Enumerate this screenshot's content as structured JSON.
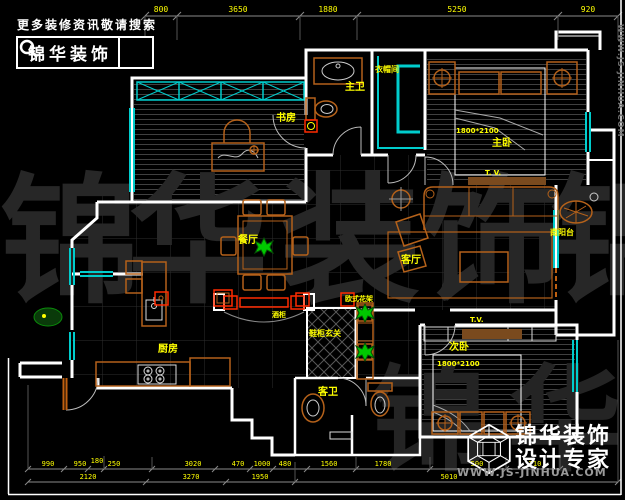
{
  "branding": {
    "search_hint": "更多装修资讯敬请搜索",
    "logo_text": "锦华装饰",
    "side_url": "WWW.JS-JINHUA.COM",
    "footer": {
      "line1": "锦华装饰",
      "line2": "设计专家",
      "url": "WWW.JS-JINHUA.COM"
    }
  },
  "watermark": {
    "row1": [
      "锦",
      "华",
      "装",
      "饰",
      "锦"
    ],
    "row2": [
      "锦",
      "华"
    ]
  },
  "floorplan": {
    "rooms": [
      {
        "id": "study",
        "label": "书房"
      },
      {
        "id": "master-bath",
        "label": "主卫"
      },
      {
        "id": "closet",
        "label": "衣帽间"
      },
      {
        "id": "master-bedroom",
        "label": "主卧"
      },
      {
        "id": "dining",
        "label": "餐厅"
      },
      {
        "id": "living",
        "label": "客厅"
      },
      {
        "id": "balcony",
        "label": "南阳台"
      },
      {
        "id": "kitchen",
        "label": "厨房"
      },
      {
        "id": "entry",
        "label": "鞋柜玄关"
      },
      {
        "id": "guest-bath",
        "label": "客卫"
      },
      {
        "id": "second-bedroom",
        "label": "次卧"
      }
    ],
    "annotations": {
      "master_bed_size": "1800*2100",
      "second_bed_size": "1800*2100",
      "master_tv": "T. V.",
      "second_tv": "T.V.",
      "wine_cabinet": "酒柜",
      "flower_stand": "欧式花架"
    }
  },
  "dimensions": {
    "top": [
      "800",
      "3650",
      "1880",
      "5250",
      "920"
    ],
    "bottom_row1": [
      "990",
      "950",
      "180",
      "250",
      "3020",
      "470",
      "1000",
      "480",
      "1560",
      "1780",
      "500",
      "710"
    ],
    "bottom_row2": [
      "2120",
      "3270",
      "1950",
      "5010"
    ]
  },
  "colors": {
    "wall": "#ffffff",
    "window": "#00cccc",
    "furniture": "#b4611a",
    "label": "#ffff00",
    "red_accent": "#ff2a00",
    "plant": "#00c800",
    "watermark": "#272727",
    "brand_label": "#ff8c00"
  }
}
